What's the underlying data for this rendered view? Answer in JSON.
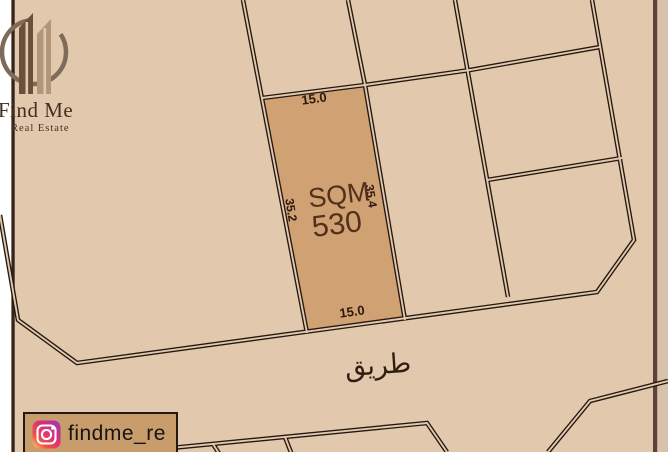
{
  "branding": {
    "logo_title": "Find Me",
    "logo_subtitle": "Real Estate"
  },
  "social": {
    "handle": "findme_re",
    "icon": "instagram"
  },
  "parcel": {
    "area_unit": "SQM",
    "area_value": "530",
    "width_top": "15.0",
    "width_bottom": "15.0",
    "depth_left": "35.2",
    "depth_right": "35.4"
  },
  "map": {
    "road_label": "طريق"
  },
  "colors": {
    "map_bg": "#e2c9ae",
    "parcel_fill": "#cfa173",
    "line": "#241810",
    "badge_bg": "#c99c6c",
    "text_dark": "#2a190f",
    "parcel_text": "#53301c",
    "border_left": "#35241d",
    "border_right": "#5c413c"
  }
}
